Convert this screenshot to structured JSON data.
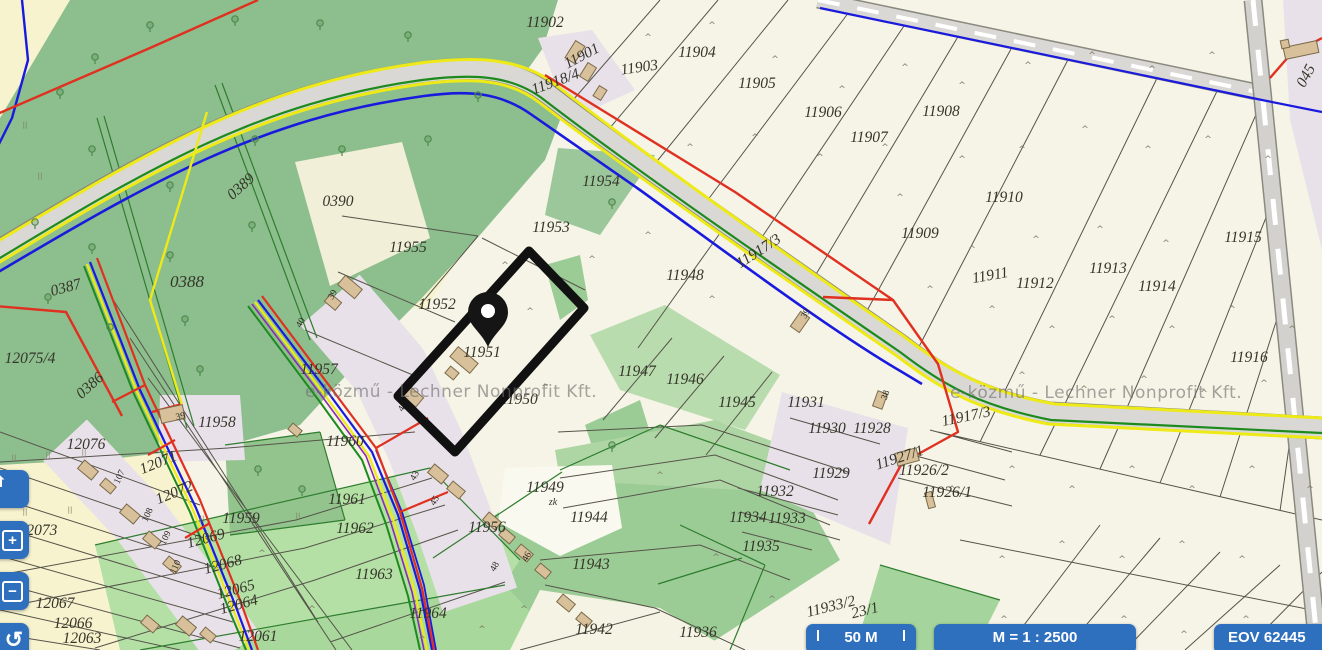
{
  "map": {
    "watermark": "e-közmű - Lechner Nonprofit Kft.",
    "watermark_positions": [
      {
        "x": 305,
        "y": 382
      },
      {
        "x": 950,
        "y": 383
      }
    ],
    "pin": {
      "x": 488,
      "y": 347
    },
    "highlight_parcel": {
      "points": "529,251 584,308 455,452 398,396",
      "label": "11951"
    },
    "parcel_labels": [
      {
        "t": "11902",
        "x": 545,
        "y": 27
      },
      {
        "t": "11901",
        "x": 584,
        "y": 60,
        "r": -28
      },
      {
        "t": "11903",
        "x": 640,
        "y": 72,
        "r": -8
      },
      {
        "t": "11904",
        "x": 697,
        "y": 57
      },
      {
        "t": "11905",
        "x": 757,
        "y": 88
      },
      {
        "t": "11906",
        "x": 823,
        "y": 117
      },
      {
        "t": "11907",
        "x": 869,
        "y": 142
      },
      {
        "t": "11908",
        "x": 941,
        "y": 116
      },
      {
        "t": "11918/4",
        "x": 557,
        "y": 86,
        "r": -20
      },
      {
        "t": "045",
        "x": 1310,
        "y": 78,
        "r": -62
      },
      {
        "t": "0390",
        "x": 338,
        "y": 206
      },
      {
        "t": "0389",
        "x": 244,
        "y": 190,
        "r": -42
      },
      {
        "t": "0388",
        "x": 187,
        "y": 287,
        "s": 17
      },
      {
        "t": "0387",
        "x": 67,
        "y": 292,
        "r": -15
      },
      {
        "t": "0386",
        "x": 93,
        "y": 389,
        "r": -42
      },
      {
        "t": "12075/4",
        "x": 30,
        "y": 363
      },
      {
        "t": "11955",
        "x": 408,
        "y": 252
      },
      {
        "t": "11954",
        "x": 601,
        "y": 186
      },
      {
        "t": "11953",
        "x": 551,
        "y": 232
      },
      {
        "t": "11952",
        "x": 437,
        "y": 309
      },
      {
        "t": "11951",
        "x": 482,
        "y": 357
      },
      {
        "t": "11950",
        "x": 519,
        "y": 404
      },
      {
        "t": "11948",
        "x": 685,
        "y": 280
      },
      {
        "t": "11917/3",
        "x": 761,
        "y": 255,
        "r": -33
      },
      {
        "t": "11917/3",
        "x": 967,
        "y": 421,
        "r": -12
      },
      {
        "t": "11947",
        "x": 637,
        "y": 376
      },
      {
        "t": "11946",
        "x": 685,
        "y": 384
      },
      {
        "t": "11945",
        "x": 737,
        "y": 407
      },
      {
        "t": "11909",
        "x": 920,
        "y": 238
      },
      {
        "t": "11910",
        "x": 1004,
        "y": 202
      },
      {
        "t": "11911",
        "x": 991,
        "y": 280,
        "r": -10
      },
      {
        "t": "11912",
        "x": 1035,
        "y": 288
      },
      {
        "t": "11913",
        "x": 1108,
        "y": 273
      },
      {
        "t": "11914",
        "x": 1157,
        "y": 291
      },
      {
        "t": "11915",
        "x": 1243,
        "y": 242
      },
      {
        "t": "11916",
        "x": 1249,
        "y": 362
      },
      {
        "t": "11931",
        "x": 806,
        "y": 407
      },
      {
        "t": "11930",
        "x": 827,
        "y": 433
      },
      {
        "t": "11928",
        "x": 872,
        "y": 433
      },
      {
        "t": "11927/1",
        "x": 901,
        "y": 462,
        "r": -18
      },
      {
        "t": "11929",
        "x": 831,
        "y": 478
      },
      {
        "t": "11926/2",
        "x": 924,
        "y": 475
      },
      {
        "t": "11926/1",
        "x": 947,
        "y": 497
      },
      {
        "t": "11932",
        "x": 775,
        "y": 496
      },
      {
        "t": "11934",
        "x": 748,
        "y": 522
      },
      {
        "t": "11933",
        "x": 787,
        "y": 523
      },
      {
        "t": "11935",
        "x": 761,
        "y": 551
      },
      {
        "t": "11949",
        "x": 545,
        "y": 492
      },
      {
        "t": "zk",
        "x": 553,
        "y": 505,
        "s": 10
      },
      {
        "t": "11944",
        "x": 589,
        "y": 522
      },
      {
        "t": "11956",
        "x": 487,
        "y": 532
      },
      {
        "t": "11943",
        "x": 591,
        "y": 569
      },
      {
        "t": "11942",
        "x": 594,
        "y": 634
      },
      {
        "t": "11936",
        "x": 698,
        "y": 637
      },
      {
        "t": "11964",
        "x": 428,
        "y": 618
      },
      {
        "t": "11963",
        "x": 374,
        "y": 579
      },
      {
        "t": "11962",
        "x": 355,
        "y": 533
      },
      {
        "t": "11961",
        "x": 347,
        "y": 504
      },
      {
        "t": "11960",
        "x": 345,
        "y": 446
      },
      {
        "t": "11959",
        "x": 241,
        "y": 523
      },
      {
        "t": "11958",
        "x": 217,
        "y": 427
      },
      {
        "t": "11957",
        "x": 319,
        "y": 374
      },
      {
        "t": "12076",
        "x": 86,
        "y": 449
      },
      {
        "t": "12071",
        "x": 160,
        "y": 467,
        "r": -22
      },
      {
        "t": "12072",
        "x": 176,
        "y": 497,
        "r": -22
      },
      {
        "t": "12073",
        "x": 38,
        "y": 535
      },
      {
        "t": "12069",
        "x": 207,
        "y": 543,
        "r": -15
      },
      {
        "t": "12068",
        "x": 224,
        "y": 569,
        "r": -15
      },
      {
        "t": "12065",
        "x": 237,
        "y": 594,
        "r": -15
      },
      {
        "t": "12064",
        "x": 240,
        "y": 609,
        "r": -15
      },
      {
        "t": "12067",
        "x": 55,
        "y": 608
      },
      {
        "t": "12066",
        "x": 73,
        "y": 628
      },
      {
        "t": "12063",
        "x": 82,
        "y": 643
      },
      {
        "t": "12061",
        "x": 258,
        "y": 641
      },
      {
        "t": "11933/2",
        "x": 832,
        "y": 611,
        "r": -14
      },
      {
        "t": "23/1",
        "x": 866,
        "y": 615,
        "r": -14
      }
    ],
    "address_numbers": [
      {
        "t": "39",
        "x": 335,
        "y": 296,
        "r": -60
      },
      {
        "t": "40",
        "x": 303,
        "y": 324,
        "r": -60
      },
      {
        "t": "42",
        "x": 405,
        "y": 408,
        "r": -60
      },
      {
        "t": "43",
        "x": 417,
        "y": 477,
        "r": -60
      },
      {
        "t": "45",
        "x": 437,
        "y": 502,
        "r": -60
      },
      {
        "t": "46",
        "x": 529,
        "y": 558,
        "r": -60
      },
      {
        "t": "48",
        "x": 497,
        "y": 568,
        "r": -60
      },
      {
        "t": "39",
        "x": 808,
        "y": 315,
        "r": -60
      },
      {
        "t": "38",
        "x": 888,
        "y": 396,
        "r": -70
      },
      {
        "t": "39",
        "x": 181,
        "y": 419,
        "r": -12
      },
      {
        "t": "107",
        "x": 122,
        "y": 478,
        "r": -65
      },
      {
        "t": "108",
        "x": 150,
        "y": 516,
        "r": -65
      },
      {
        "t": "109",
        "x": 168,
        "y": 539,
        "r": -65
      },
      {
        "t": "110",
        "x": 178,
        "y": 568,
        "r": -65
      }
    ],
    "trees": [
      [
        95,
        60
      ],
      [
        150,
        28
      ],
      [
        235,
        22
      ],
      [
        320,
        26
      ],
      [
        408,
        38
      ],
      [
        478,
        98
      ],
      [
        60,
        95
      ],
      [
        92,
        152
      ],
      [
        170,
        188
      ],
      [
        255,
        142
      ],
      [
        342,
        152
      ],
      [
        428,
        142
      ],
      [
        35,
        225
      ],
      [
        92,
        250
      ],
      [
        170,
        258
      ],
      [
        252,
        228
      ],
      [
        110,
        330
      ],
      [
        185,
        322
      ],
      [
        48,
        300
      ],
      [
        200,
        372
      ],
      [
        612,
        205
      ],
      [
        258,
        472
      ],
      [
        302,
        492
      ],
      [
        612,
        448
      ]
    ],
    "meadow_marks": [
      [
        648,
        40
      ],
      [
        712,
        28
      ],
      [
        775,
        62
      ],
      [
        842,
        92
      ],
      [
        905,
        70
      ],
      [
        962,
        88
      ],
      [
        1028,
        68
      ],
      [
        1092,
        58
      ],
      [
        1152,
        72
      ],
      [
        1212,
        58
      ],
      [
        690,
        150
      ],
      [
        755,
        140
      ],
      [
        820,
        160
      ],
      [
        885,
        150
      ],
      [
        900,
        200
      ],
      [
        962,
        162
      ],
      [
        1022,
        152
      ],
      [
        1085,
        132
      ],
      [
        1148,
        152
      ],
      [
        1208,
        142
      ],
      [
        1268,
        162
      ],
      [
        930,
        292
      ],
      [
        992,
        312
      ],
      [
        1052,
        332
      ],
      [
        1112,
        322
      ],
      [
        1172,
        332
      ],
      [
        1232,
        312
      ],
      [
        1292,
        332
      ],
      [
        972,
        252
      ],
      [
        1036,
        242
      ],
      [
        1100,
        232
      ],
      [
        1166,
        246
      ],
      [
        1022,
        378
      ],
      [
        1084,
        392
      ],
      [
        1144,
        382
      ],
      [
        1204,
        396
      ],
      [
        1264,
        386
      ],
      [
        952,
        492
      ],
      [
        1012,
        472
      ],
      [
        1072,
        492
      ],
      [
        1132,
        472
      ],
      [
        1192,
        492
      ],
      [
        1252,
        472
      ],
      [
        1310,
        492
      ],
      [
        1002,
        562
      ],
      [
        1062,
        547
      ],
      [
        1122,
        562
      ],
      [
        1182,
        547
      ],
      [
        1242,
        562
      ],
      [
        1004,
        622
      ],
      [
        1064,
        637
      ],
      [
        1124,
        622
      ],
      [
        1184,
        637
      ],
      [
        1246,
        622
      ],
      [
        648,
        238
      ],
      [
        712,
        302
      ],
      [
        592,
        262
      ],
      [
        660,
        478
      ],
      [
        716,
        560
      ],
      [
        772,
        602
      ],
      [
        262,
        556
      ],
      [
        312,
        612
      ],
      [
        422,
        642
      ],
      [
        482,
        632
      ],
      [
        524,
        612
      ],
      [
        530,
        314
      ],
      [
        505,
        268
      ],
      [
        545,
        390
      ]
    ],
    "tick_marks": [
      [
        14,
        460
      ],
      [
        48,
        457
      ],
      [
        84,
        454
      ],
      [
        25,
        514
      ],
      [
        70,
        512
      ],
      [
        202,
        521
      ],
      [
        298,
        518
      ],
      [
        25,
        127
      ],
      [
        40,
        178
      ]
    ]
  },
  "controls": {
    "zoom_in_glyph": "+",
    "zoom_out_glyph": "−",
    "undo_glyph": "↺"
  },
  "statusbar": {
    "scale_bar_label": "50 M",
    "map_scale_label": "M = 1 : 2500",
    "coordinates_label": "EOV  62445"
  },
  "colors": {
    "button_blue": "#2e6fbe",
    "forest_green": "#8dbe8d",
    "field_green": "#9ccc96",
    "built_up_pink": "#e9e1e9",
    "road_gray": "#d9d8d4",
    "utility_red": "#e03020",
    "utility_blue": "#1a1adf",
    "utility_green": "#1d8a1d",
    "utility_yellow": "#eeea17",
    "utility_purple": "#8a2bb0",
    "highlight_black": "#111111"
  }
}
